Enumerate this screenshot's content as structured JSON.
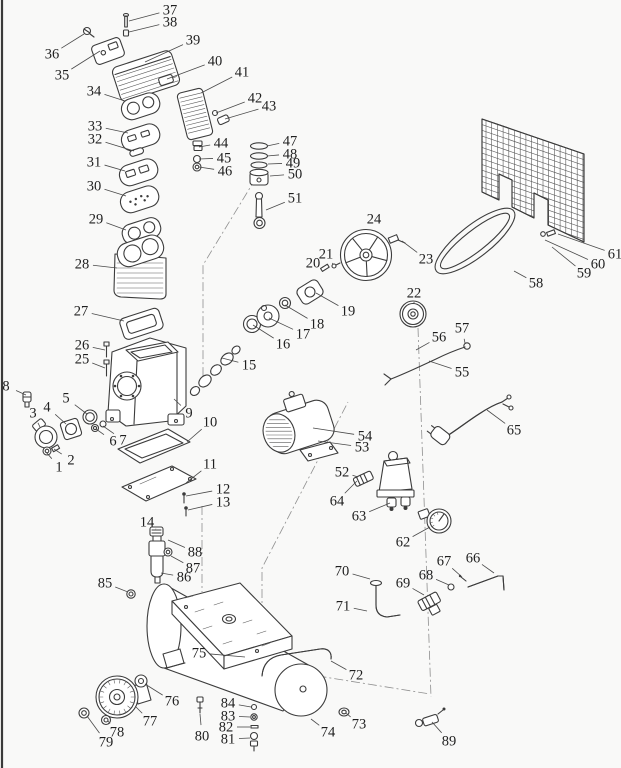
{
  "page": {
    "background": "#f9f9f8",
    "edge_line_color": "#3a3a3a"
  },
  "diagram": {
    "type": "exploded-parts-diagram",
    "subject": "air compressor exploded parts view",
    "part_count": 89,
    "line_color": "#3c3c3c",
    "label_color": "#1f1f1f",
    "label_font_size": 14.5,
    "labels": [
      {
        "n": "1",
        "x": 59,
        "y": 467,
        "lx": 46,
        "ly": 452
      },
      {
        "n": "2",
        "x": 71,
        "y": 460,
        "lx": 54,
        "ly": 449
      },
      {
        "n": "3",
        "x": 33,
        "y": 413,
        "lx": 40,
        "ly": 427
      },
      {
        "n": "4",
        "x": 47,
        "y": 407,
        "lx": 66,
        "ly": 424
      },
      {
        "n": "5",
        "x": 66,
        "y": 398,
        "lx": 87,
        "ly": 414
      },
      {
        "n": "6",
        "x": 113,
        "y": 441,
        "lx": 96,
        "ly": 429
      },
      {
        "n": "7",
        "x": 123,
        "y": 440,
        "lx": 103,
        "ly": 426
      },
      {
        "n": "8",
        "x": 6,
        "y": 386,
        "lx": 26,
        "ly": 395
      },
      {
        "n": "9",
        "x": 189,
        "y": 413,
        "lx": 174,
        "ly": 399
      },
      {
        "n": "10",
        "x": 210,
        "y": 422,
        "lx": 187,
        "ly": 442
      },
      {
        "n": "11",
        "x": 210,
        "y": 464,
        "lx": 186,
        "ly": 483
      },
      {
        "n": "12",
        "x": 223,
        "y": 489,
        "lx": 186,
        "ly": 496
      },
      {
        "n": "13",
        "x": 223,
        "y": 502,
        "lx": 188,
        "ly": 510
      },
      {
        "n": "14",
        "x": 147,
        "y": 522,
        "lx": 156,
        "ly": 529
      },
      {
        "n": "15",
        "x": 249,
        "y": 365,
        "lx": 222,
        "ly": 358
      },
      {
        "n": "16",
        "x": 283,
        "y": 344,
        "lx": 253,
        "ly": 325
      },
      {
        "n": "17",
        "x": 303,
        "y": 334,
        "lx": 269,
        "ly": 318
      },
      {
        "n": "18",
        "x": 317,
        "y": 324,
        "lx": 285,
        "ly": 305
      },
      {
        "n": "19",
        "x": 348,
        "y": 311,
        "lx": 316,
        "ly": 293
      },
      {
        "n": "20",
        "x": 313,
        "y": 263,
        "lx": 322,
        "ly": 267
      },
      {
        "n": "21",
        "x": 326,
        "y": 254,
        "lx": 333,
        "ly": 264
      },
      {
        "n": "22",
        "x": 414,
        "y": 293,
        "lx": 414,
        "ly": 302
      },
      {
        "n": "23",
        "x": 426,
        "y": 259,
        "lx": 402,
        "ly": 241
      },
      {
        "n": "24",
        "x": 374,
        "y": 219,
        "lx": 372,
        "ly": 230
      },
      {
        "n": "25",
        "x": 82,
        "y": 359,
        "lx": 105,
        "ly": 368
      },
      {
        "n": "26",
        "x": 82,
        "y": 345,
        "lx": 105,
        "ly": 350
      },
      {
        "n": "27",
        "x": 81,
        "y": 311,
        "lx": 124,
        "ly": 321
      },
      {
        "n": "28",
        "x": 82,
        "y": 264,
        "lx": 117,
        "ly": 268
      },
      {
        "n": "29",
        "x": 96,
        "y": 219,
        "lx": 126,
        "ly": 230
      },
      {
        "n": "30",
        "x": 94,
        "y": 186,
        "lx": 126,
        "ly": 196
      },
      {
        "n": "31",
        "x": 94,
        "y": 162,
        "lx": 125,
        "ly": 171
      },
      {
        "n": "32",
        "x": 95,
        "y": 139,
        "lx": 134,
        "ly": 151
      },
      {
        "n": "33",
        "x": 95,
        "y": 126,
        "lx": 128,
        "ly": 133
      },
      {
        "n": "34",
        "x": 94,
        "y": 91,
        "lx": 125,
        "ly": 101
      },
      {
        "n": "35",
        "x": 62,
        "y": 75,
        "lx": 100,
        "ly": 51
      },
      {
        "n": "36",
        "x": 52,
        "y": 54,
        "lx": 84,
        "ly": 34
      },
      {
        "n": "37",
        "x": 170,
        "y": 10,
        "lx": 129,
        "ly": 21
      },
      {
        "n": "38",
        "x": 170,
        "y": 22,
        "lx": 129,
        "ly": 32
      },
      {
        "n": "39",
        "x": 193,
        "y": 40,
        "lx": 145,
        "ly": 62
      },
      {
        "n": "40",
        "x": 215,
        "y": 61,
        "lx": 167,
        "ly": 79
      },
      {
        "n": "41",
        "x": 242,
        "y": 72,
        "lx": 201,
        "ly": 93
      },
      {
        "n": "42",
        "x": 255,
        "y": 98,
        "lx": 216,
        "ly": 113
      },
      {
        "n": "43",
        "x": 269,
        "y": 106,
        "lx": 225,
        "ly": 119
      },
      {
        "n": "44",
        "x": 221,
        "y": 143,
        "lx": 199,
        "ly": 147
      },
      {
        "n": "45",
        "x": 224,
        "y": 158,
        "lx": 199,
        "ly": 159
      },
      {
        "n": "46",
        "x": 225,
        "y": 171,
        "lx": 199,
        "ly": 167
      },
      {
        "n": "47",
        "x": 290,
        "y": 141,
        "lx": 267,
        "ly": 146
      },
      {
        "n": "48",
        "x": 290,
        "y": 154,
        "lx": 267,
        "ly": 156
      },
      {
        "n": "49",
        "x": 293,
        "y": 163,
        "lx": 268,
        "ly": 164
      },
      {
        "n": "50",
        "x": 295,
        "y": 174,
        "lx": 270,
        "ly": 176
      },
      {
        "n": "51",
        "x": 295,
        "y": 198,
        "lx": 266,
        "ly": 210
      },
      {
        "n": "52",
        "x": 342,
        "y": 472,
        "lx": 358,
        "ly": 477
      },
      {
        "n": "53",
        "x": 362,
        "y": 447,
        "lx": 318,
        "ly": 441
      },
      {
        "n": "54",
        "x": 365,
        "y": 436,
        "lx": 313,
        "ly": 428
      },
      {
        "n": "55",
        "x": 462,
        "y": 372,
        "lx": 429,
        "ly": 361
      },
      {
        "n": "56",
        "x": 439,
        "y": 337,
        "lx": 416,
        "ly": 350
      },
      {
        "n": "57",
        "x": 462,
        "y": 328,
        "lx": 465,
        "ly": 343
      },
      {
        "n": "58",
        "x": 536,
        "y": 283,
        "lx": 514,
        "ly": 271
      },
      {
        "n": "59",
        "x": 584,
        "y": 273,
        "lx": 552,
        "ly": 247
      },
      {
        "n": "60",
        "x": 598,
        "y": 264,
        "lx": 545,
        "ly": 240
      },
      {
        "n": "61",
        "x": 615,
        "y": 254,
        "lx": 558,
        "ly": 234
      },
      {
        "n": "62",
        "x": 403,
        "y": 542,
        "lx": 430,
        "ly": 527
      },
      {
        "n": "63",
        "x": 359,
        "y": 516,
        "lx": 390,
        "ly": 503
      },
      {
        "n": "64",
        "x": 337,
        "y": 501,
        "lx": 357,
        "ly": 481
      },
      {
        "n": "65",
        "x": 514,
        "y": 430,
        "lx": 487,
        "ly": 410
      },
      {
        "n": "66",
        "x": 473,
        "y": 558,
        "lx": 494,
        "ly": 573
      },
      {
        "n": "67",
        "x": 444,
        "y": 561,
        "lx": 462,
        "ly": 577
      },
      {
        "n": "68",
        "x": 426,
        "y": 575,
        "lx": 449,
        "ly": 585
      },
      {
        "n": "69",
        "x": 403,
        "y": 583,
        "lx": 424,
        "ly": 595
      },
      {
        "n": "70",
        "x": 342,
        "y": 571,
        "lx": 370,
        "ly": 579
      },
      {
        "n": "71",
        "x": 343,
        "y": 606,
        "lx": 367,
        "ly": 611
      },
      {
        "n": "72",
        "x": 356,
        "y": 675,
        "lx": 331,
        "ly": 661
      },
      {
        "n": "73",
        "x": 359,
        "y": 724,
        "lx": 346,
        "ly": 713
      },
      {
        "n": "74",
        "x": 328,
        "y": 732,
        "lx": 311,
        "ly": 719
      },
      {
        "n": "75",
        "x": 199,
        "y": 653,
        "lx": 245,
        "ly": 657
      },
      {
        "n": "76",
        "x": 172,
        "y": 701,
        "lx": 145,
        "ly": 684
      },
      {
        "n": "77",
        "x": 150,
        "y": 721,
        "lx": 136,
        "ly": 707
      },
      {
        "n": "78",
        "x": 117,
        "y": 732,
        "lx": 108,
        "ly": 721
      },
      {
        "n": "79",
        "x": 106,
        "y": 742,
        "lx": 87,
        "ly": 716
      },
      {
        "n": "80",
        "x": 202,
        "y": 736,
        "lx": 200,
        "ly": 714
      },
      {
        "n": "81",
        "x": 228,
        "y": 739,
        "lx": 250,
        "ly": 738
      },
      {
        "n": "82",
        "x": 226,
        "y": 727,
        "lx": 250,
        "ly": 727
      },
      {
        "n": "83",
        "x": 228,
        "y": 716,
        "lx": 250,
        "ly": 717
      },
      {
        "n": "84",
        "x": 228,
        "y": 703,
        "lx": 251,
        "ly": 707
      },
      {
        "n": "85",
        "x": 105,
        "y": 583,
        "lx": 128,
        "ly": 592
      },
      {
        "n": "86",
        "x": 184,
        "y": 577,
        "lx": 161,
        "ly": 573
      },
      {
        "n": "87",
        "x": 193,
        "y": 568,
        "lx": 171,
        "ly": 556
      },
      {
        "n": "88",
        "x": 195,
        "y": 552,
        "lx": 168,
        "ly": 540
      },
      {
        "n": "89",
        "x": 449,
        "y": 741,
        "lx": 432,
        "ly": 722
      }
    ],
    "construction_lines": [
      [
        256,
        178,
        203,
        265,
        203,
        378
      ],
      [
        262,
        632,
        262,
        568,
        348,
        402
      ],
      [
        418,
        328,
        431,
        697
      ],
      [
        202,
        506,
        202,
        592
      ],
      [
        200,
        657,
        430,
        694
      ]
    ]
  }
}
